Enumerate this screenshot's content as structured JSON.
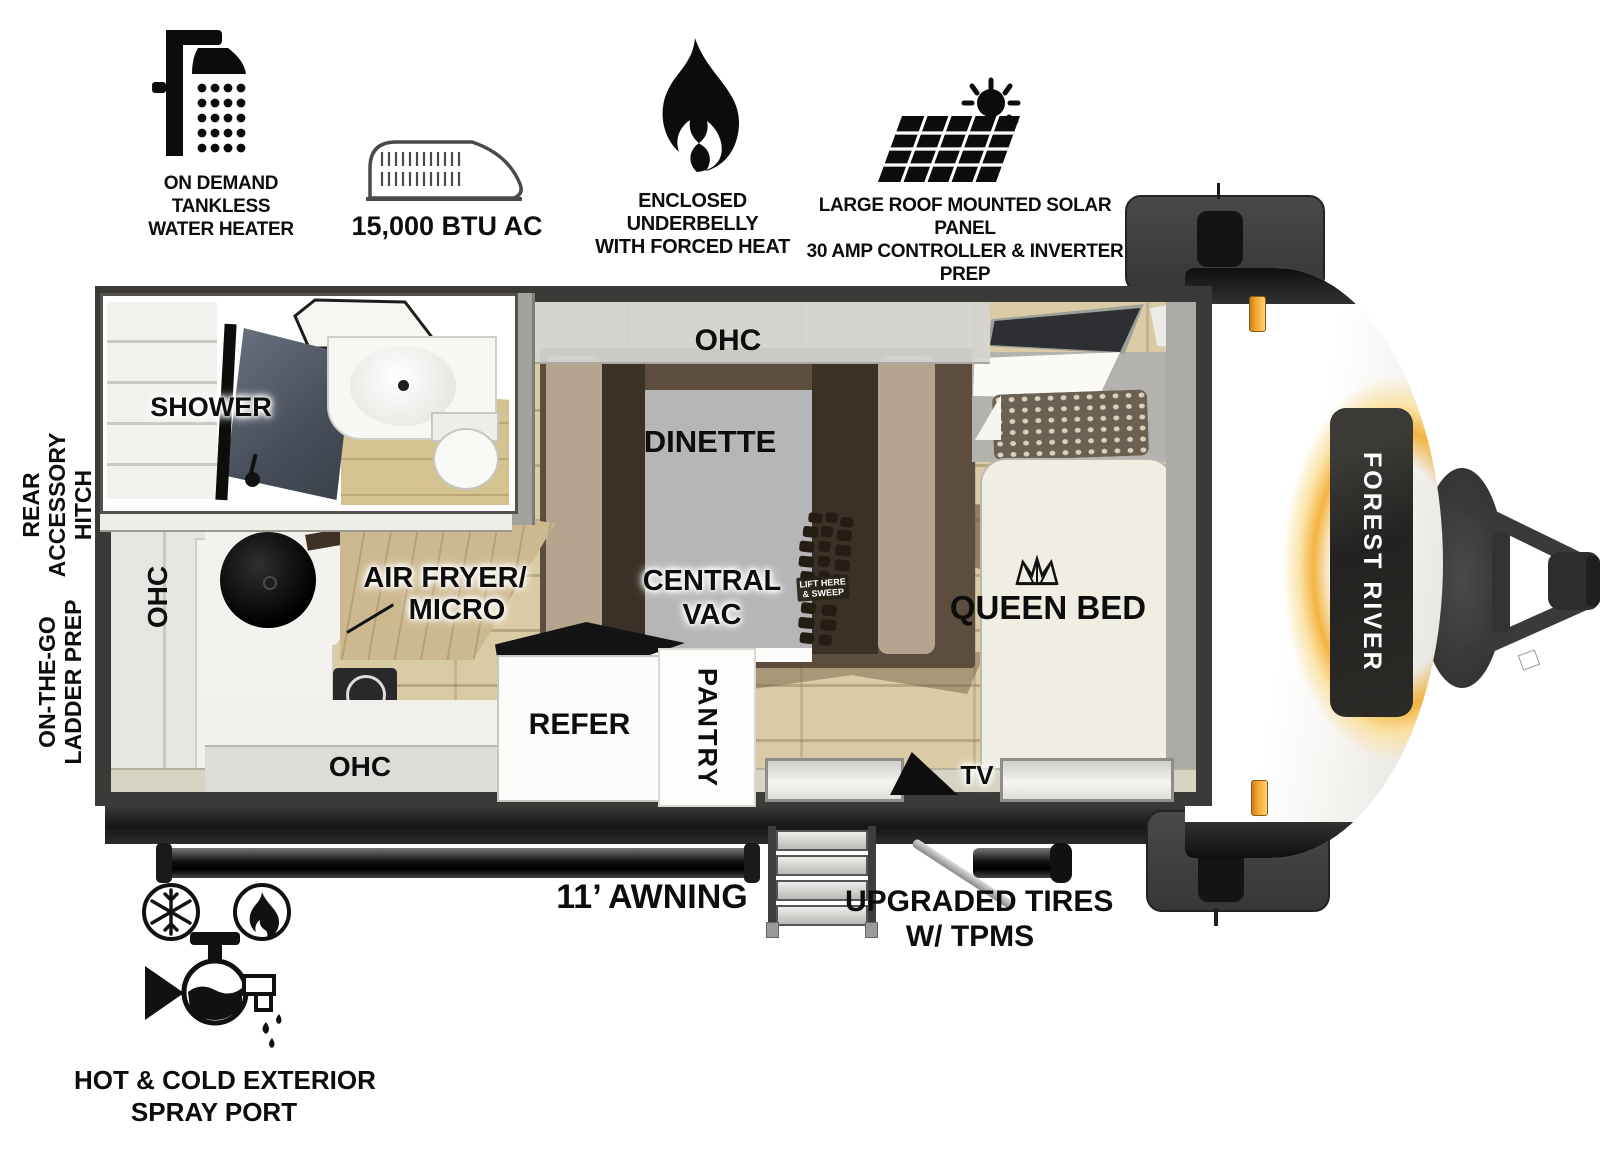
{
  "features": {
    "water_heater": {
      "icon": "shower-icon",
      "lines": [
        "ON DEMAND",
        "TANKLESS",
        "WATER HEATER"
      ]
    },
    "ac": {
      "icon": "ac-unit-icon",
      "label": "15,000 BTU AC"
    },
    "underbelly": {
      "icon": "flame-icon",
      "lines": [
        "ENCLOSED UNDERBELLY",
        "WITH FORCED HEAT"
      ]
    },
    "solar": {
      "icon": "solar-panel-icon",
      "lines": [
        "LARGE ROOF MOUNTED SOLAR PANEL",
        "30 AMP CONTROLLER & INVERTER PREP"
      ]
    },
    "spray_port": {
      "icon": "spray-port-icon",
      "lines": [
        "HOT & COLD EXTERIOR",
        "SPRAY PORT"
      ]
    }
  },
  "side_labels": {
    "rear_hitch": {
      "lines": [
        "REAR",
        "ACCESSORY",
        "HITCH"
      ]
    },
    "ladder_prep": {
      "lines": [
        "ON-THE-GO",
        "LADDER PREP"
      ]
    }
  },
  "floorplan": {
    "shower": "SHOWER",
    "ohc_top": "OHC",
    "ohc_left": "OHC",
    "ohc_bottom": "OHC",
    "dinette": "DINETTE",
    "queen_bed": "QUEEN BED",
    "central_vac": {
      "lines": [
        "CENTRAL",
        "VAC"
      ]
    },
    "air_fryer": {
      "lines": [
        "AIR FRYER/",
        "MICRO"
      ]
    },
    "refer": "REFER",
    "pantry": "PANTRY",
    "tv": "TV",
    "boot_badge": {
      "lines": [
        "LIFT HERE",
        "& SWEEP"
      ]
    }
  },
  "exterior": {
    "awning": "11’ AWNING",
    "tires": {
      "lines": [
        "UPGRADED TIRES",
        "W/ TPMS"
      ]
    },
    "brand": "FOREST RIVER"
  },
  "colors": {
    "wall": "#3b3a38",
    "floor": "#d9cba4",
    "accent_orange": "#f2a33c",
    "glow": "#f3b048"
  }
}
